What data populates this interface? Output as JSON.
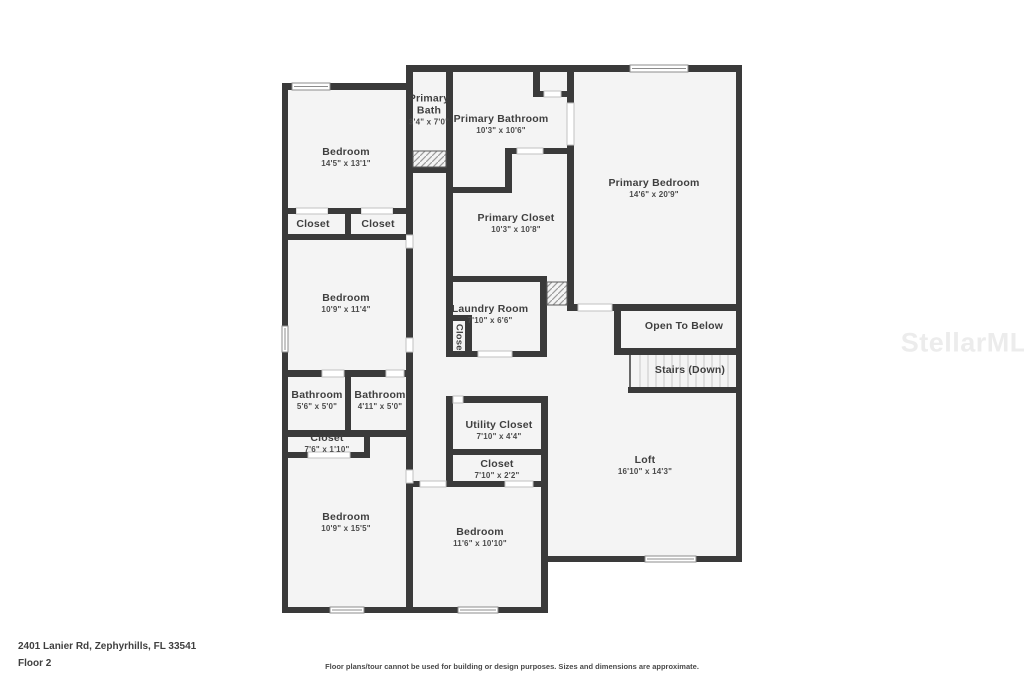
{
  "colors": {
    "wall": "#3a3a3a",
    "room_fill": "#f4f4f4",
    "background": "#ffffff"
  },
  "rooms": {
    "bedroom_top_left": {
      "name": "Bedroom",
      "dims": "14'5\" x 13'1\""
    },
    "primary_bath": {
      "name": "Primary Bath",
      "dims": "3'4\" x 7'0\""
    },
    "primary_bathroom": {
      "name": "Primary Bathroom",
      "dims": "10'3\" x 10'6\""
    },
    "primary_bedroom": {
      "name": "Primary Bedroom",
      "dims": "14'6\" x 20'9\""
    },
    "closet_a": {
      "name": "Closet"
    },
    "closet_b": {
      "name": "Closet"
    },
    "bedroom_mid_left": {
      "name": "Bedroom",
      "dims": "10'9\" x 11'4\""
    },
    "primary_closet": {
      "name": "Primary Closet",
      "dims": "10'3\" x 10'8\""
    },
    "laundry_room": {
      "name": "Laundry Room",
      "dims": "7'10\" x 6'6\""
    },
    "laundry_closet": {
      "name": "Closet"
    },
    "open_to_below": {
      "name": "Open To Below"
    },
    "stairs": {
      "name": "Stairs (Down)"
    },
    "bathroom_a": {
      "name": "Bathroom",
      "dims": "5'6\" x 5'0\""
    },
    "bathroom_b": {
      "name": "Bathroom",
      "dims": "4'11\" x 5'0\""
    },
    "closet_c": {
      "name": "Closet",
      "dims": "7'6\" x 1'10\""
    },
    "utility_closet": {
      "name": "Utility Closet",
      "dims": "7'10\" x 4'4\""
    },
    "closet_d": {
      "name": "Closet",
      "dims": "7'10\" x 2'2\""
    },
    "bedroom_bottom_left": {
      "name": "Bedroom",
      "dims": "10'9\" x 15'5\""
    },
    "bedroom_bottom_mid": {
      "name": "Bedroom",
      "dims": "11'6\" x 10'10\""
    },
    "loft": {
      "name": "Loft",
      "dims": "16'10\" x 14'3\""
    }
  },
  "footer": {
    "address": "2401 Lanier Rd, Zephyrhills, FL 33541",
    "floor": "Floor 2",
    "disclaimer": "Floor plans/tour cannot be used for building or design purposes. Sizes and dimensions are approximate."
  },
  "watermark": {
    "text": "StellarMLS"
  }
}
